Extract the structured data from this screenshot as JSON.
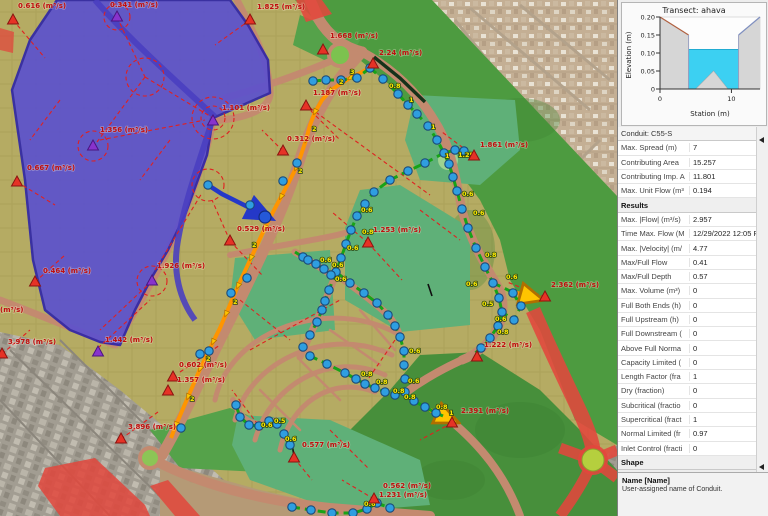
{
  "panel": {
    "transect": {
      "title": "Transect: ahava",
      "ylabel": "Elevation (m)",
      "xlabel": "Station (m)",
      "chart_data": {
        "type": "area",
        "x_range": [
          0,
          14
        ],
        "y_range": [
          0,
          0.2
        ],
        "yticks": [
          {
            "v": "0.20",
            "e": 0.2
          },
          {
            "v": "0.15",
            "e": 0.15
          },
          {
            "v": "0.10",
            "e": 0.1
          },
          {
            "v": "0.05",
            "e": 0.05
          },
          {
            "v": "0",
            "e": 0.0
          }
        ],
        "xticks": [
          {
            "v": "0",
            "s": 0
          },
          {
            "v": "10",
            "s": 10
          }
        ],
        "ground_left": [
          [
            0,
            0.2
          ],
          [
            4,
            0.15
          ]
        ],
        "ground_right": [
          [
            11,
            0.15
          ],
          [
            14,
            0.2
          ]
        ],
        "channel_top": 0.15,
        "water_level": 0.11,
        "island": [
          [
            5,
            0
          ],
          [
            7.5,
            0.05
          ],
          [
            9.5,
            0
          ]
        ],
        "water_color": "#3cd0f2"
      }
    },
    "grid": {
      "rows": [
        {
          "type": "cat0",
          "label": "Conduit: C55-S"
        },
        {
          "type": "row",
          "label": "Max. Spread (m)",
          "value": "7"
        },
        {
          "type": "row",
          "label": "Contributing Area",
          "value": "15.257"
        },
        {
          "type": "row",
          "label": "Contributing Imp. A",
          "value": "11.801"
        },
        {
          "type": "row",
          "label": "Max. Unit Flow (m³",
          "value": "0.194"
        },
        {
          "type": "cat",
          "label": "Results"
        },
        {
          "type": "row",
          "label": "Max. |Flow| (m³/s)",
          "value": "2.957"
        },
        {
          "type": "row",
          "label": "Time Max. Flow (M",
          "value": "12/29/2022 12:05 PM"
        },
        {
          "type": "row",
          "label": "Max. |Velocity| (m/",
          "value": "4.77"
        },
        {
          "type": "row",
          "label": "Max/Full Flow",
          "value": "0.41"
        },
        {
          "type": "row",
          "label": "Max/Full Depth",
          "value": "0.57"
        },
        {
          "type": "row",
          "label": "Max. Volume (m³)",
          "value": "0"
        },
        {
          "type": "row",
          "label": "Full Both Ends (h)",
          "value": "0"
        },
        {
          "type": "row",
          "label": "Full Upstream (h)",
          "value": "0"
        },
        {
          "type": "row",
          "label": "Full Downstream (",
          "value": "0"
        },
        {
          "type": "row",
          "label": "Above Full Norma",
          "value": "0"
        },
        {
          "type": "row",
          "label": "Capacity Limited (",
          "value": "0"
        },
        {
          "type": "row",
          "label": "Length Factor (fra",
          "value": "1"
        },
        {
          "type": "row",
          "label": "Dry (fraction)",
          "value": "0"
        },
        {
          "type": "row",
          "label": "Subcritical (fractio",
          "value": "0"
        },
        {
          "type": "row",
          "label": "Supercritical (fract",
          "value": "1"
        },
        {
          "type": "row",
          "label": "Normal Limited (fr",
          "value": "0.97"
        },
        {
          "type": "row",
          "label": "Inlet Control (fracti",
          "value": "0"
        },
        {
          "type": "cat",
          "label": "Shape"
        }
      ]
    },
    "description": {
      "title": "Name [Name]",
      "text": "User-assigned name of Conduit."
    }
  },
  "map": {
    "flow_labels": [
      {
        "text": "0.616 (m³/s)",
        "x": 18,
        "y": 8
      },
      {
        "text": "0.341 (m³/s)",
        "x": 110,
        "y": 7
      },
      {
        "text": "1.825 (m³/s)",
        "x": 257,
        "y": 9
      },
      {
        "text": "1.668 (m³/s)",
        "x": 330,
        "y": 38
      },
      {
        "text": "2.24 (m³/s)",
        "x": 379,
        "y": 55
      },
      {
        "text": "1.187 (m³/s)",
        "x": 313,
        "y": 95
      },
      {
        "text": "1.101 (m³/s)",
        "x": 222,
        "y": 110
      },
      {
        "text": "1.356 (m³/s)",
        "x": 100,
        "y": 132
      },
      {
        "text": "0.312 (m³/s)",
        "x": 287,
        "y": 141
      },
      {
        "text": "1.861 (m³/s)",
        "x": 480,
        "y": 147
      },
      {
        "text": "0.667 (m³/s)",
        "x": 27,
        "y": 170
      },
      {
        "text": "0.529 (m³/s)",
        "x": 237,
        "y": 231
      },
      {
        "text": "1.253 (m³/s)",
        "x": 373,
        "y": 232
      },
      {
        "text": "0.464 (m³/s)",
        "x": 43,
        "y": 273
      },
      {
        "text": "1.926 (m³/s)",
        "x": 157,
        "y": 268
      },
      {
        "text": "2.362 (m³/s)",
        "x": 551,
        "y": 287
      },
      {
        "text": "(m³/s)",
        "x": 0,
        "y": 312
      },
      {
        "text": "3.978 (m³/s)",
        "x": 8,
        "y": 344
      },
      {
        "text": "1.442 (m³/s)",
        "x": 105,
        "y": 342
      },
      {
        "text": "1.222 (m³/s)",
        "x": 484,
        "y": 347
      },
      {
        "text": "0.602 (m³/s)",
        "x": 179,
        "y": 367
      },
      {
        "text": "1.357 (m³/s)",
        "x": 177,
        "y": 382
      },
      {
        "text": "2.391 (m³/s)",
        "x": 461,
        "y": 413
      },
      {
        "text": "3.896 (m³/s)",
        "x": 128,
        "y": 429
      },
      {
        "text": "0.577 (m³/s)",
        "x": 302,
        "y": 447
      },
      {
        "text": "0.562 (m³/s)",
        "x": 383,
        "y": 488
      },
      {
        "text": "1.231 (m³/s)",
        "x": 379,
        "y": 497
      }
    ],
    "triangles": [
      {
        "x": 13,
        "y": 20,
        "c": "red"
      },
      {
        "x": 117,
        "y": 17,
        "c": "purple"
      },
      {
        "x": 250,
        "y": 20,
        "c": "red"
      },
      {
        "x": 323,
        "y": 50,
        "c": "red"
      },
      {
        "x": 373,
        "y": 64,
        "c": "red"
      },
      {
        "x": 306,
        "y": 106,
        "c": "red"
      },
      {
        "x": 213,
        "y": 121,
        "c": "purple"
      },
      {
        "x": 93,
        "y": 146,
        "c": "purple"
      },
      {
        "x": 283,
        "y": 151,
        "c": "red"
      },
      {
        "x": 474,
        "y": 156,
        "c": "red"
      },
      {
        "x": 17,
        "y": 182,
        "c": "red"
      },
      {
        "x": 230,
        "y": 241,
        "c": "red"
      },
      {
        "x": 368,
        "y": 243,
        "c": "red"
      },
      {
        "x": 545,
        "y": 297,
        "c": "red"
      },
      {
        "x": 35,
        "y": 282,
        "c": "red"
      },
      {
        "x": 152,
        "y": 281,
        "c": "purple"
      },
      {
        "x": 2,
        "y": 354,
        "c": "red"
      },
      {
        "x": 98,
        "y": 352,
        "c": "purple"
      },
      {
        "x": 173,
        "y": 377,
        "c": "red"
      },
      {
        "x": 168,
        "y": 391,
        "c": "red"
      },
      {
        "x": 121,
        "y": 439,
        "c": "red"
      },
      {
        "x": 294,
        "y": 458,
        "c": "red"
      },
      {
        "x": 477,
        "y": 357,
        "c": "red"
      },
      {
        "x": 452,
        "y": 423,
        "c": "red"
      },
      {
        "x": 374,
        "y": 499,
        "c": "red"
      }
    ],
    "net_labels": [
      {
        "text": "3",
        "x": 350,
        "y": 74
      },
      {
        "text": "2",
        "x": 339,
        "y": 84
      },
      {
        "text": "2",
        "x": 312,
        "y": 131
      },
      {
        "text": "2",
        "x": 298,
        "y": 173
      },
      {
        "text": "2",
        "x": 252,
        "y": 247
      },
      {
        "text": "2",
        "x": 233,
        "y": 304
      },
      {
        "text": "2",
        "x": 206,
        "y": 361
      },
      {
        "text": "2",
        "x": 190,
        "y": 401
      },
      {
        "text": "0.8",
        "x": 389,
        "y": 88
      },
      {
        "text": "1",
        "x": 409,
        "y": 102
      },
      {
        "text": "1",
        "x": 431,
        "y": 129
      },
      {
        "text": "1",
        "x": 445,
        "y": 158
      },
      {
        "text": "1.25",
        "x": 458,
        "y": 157
      },
      {
        "text": "0.6",
        "x": 462,
        "y": 196
      },
      {
        "text": "0.6",
        "x": 473,
        "y": 215
      },
      {
        "text": "0.8",
        "x": 485,
        "y": 257
      },
      {
        "text": "0.6",
        "x": 466,
        "y": 286
      },
      {
        "text": "0.6",
        "x": 506,
        "y": 279
      },
      {
        "text": "0.5",
        "x": 482,
        "y": 306
      },
      {
        "text": "0.6",
        "x": 495,
        "y": 321
      },
      {
        "text": "0.8",
        "x": 497,
        "y": 334
      },
      {
        "text": "0.6",
        "x": 361,
        "y": 212
      },
      {
        "text": "0.8",
        "x": 362,
        "y": 234
      },
      {
        "text": "0.6",
        "x": 347,
        "y": 250
      },
      {
        "text": "0.6",
        "x": 320,
        "y": 262
      },
      {
        "text": "0.6",
        "x": 332,
        "y": 267
      },
      {
        "text": "0.6",
        "x": 335,
        "y": 281
      },
      {
        "text": "0.6",
        "x": 409,
        "y": 353
      },
      {
        "text": "0.6",
        "x": 408,
        "y": 383
      },
      {
        "text": "0.8",
        "x": 361,
        "y": 376
      },
      {
        "text": "0.8",
        "x": 376,
        "y": 384
      },
      {
        "text": "0.8",
        "x": 393,
        "y": 393
      },
      {
        "text": "0.8",
        "x": 404,
        "y": 399
      },
      {
        "text": "0.8",
        "x": 436,
        "y": 409
      },
      {
        "text": "1",
        "x": 449,
        "y": 415
      },
      {
        "text": "0.6",
        "x": 261,
        "y": 427
      },
      {
        "text": "0.5",
        "x": 274,
        "y": 423
      },
      {
        "text": "0.6",
        "x": 285,
        "y": 441
      },
      {
        "text": "0.6",
        "x": 364,
        "y": 506
      }
    ],
    "junctions": [
      [
        313,
        81
      ],
      [
        326,
        80
      ],
      [
        341,
        80
      ],
      [
        357,
        78
      ],
      [
        370,
        68
      ],
      [
        383,
        79
      ],
      [
        398,
        94
      ],
      [
        408,
        105
      ],
      [
        417,
        114
      ],
      [
        428,
        126
      ],
      [
        437,
        140
      ],
      [
        444,
        153
      ],
      [
        449,
        164
      ],
      [
        453,
        177
      ],
      [
        457,
        191
      ],
      [
        462,
        209
      ],
      [
        468,
        228
      ],
      [
        476,
        248
      ],
      [
        485,
        267
      ],
      [
        493,
        283
      ],
      [
        499,
        298
      ],
      [
        502,
        312
      ],
      [
        498,
        326
      ],
      [
        490,
        338
      ],
      [
        481,
        348
      ],
      [
        455,
        150
      ],
      [
        464,
        151
      ],
      [
        513,
        293
      ],
      [
        521,
        306
      ],
      [
        514,
        320
      ],
      [
        425,
        163
      ],
      [
        408,
        171
      ],
      [
        390,
        180
      ],
      [
        374,
        192
      ],
      [
        365,
        204
      ],
      [
        357,
        216
      ],
      [
        351,
        230
      ],
      [
        346,
        244
      ],
      [
        341,
        258
      ],
      [
        336,
        272
      ],
      [
        303,
        257
      ],
      [
        308,
        260
      ],
      [
        316,
        264
      ],
      [
        324,
        269
      ],
      [
        331,
        275
      ],
      [
        350,
        283
      ],
      [
        364,
        293
      ],
      [
        377,
        303
      ],
      [
        388,
        315
      ],
      [
        395,
        326
      ],
      [
        400,
        337
      ],
      [
        404,
        351
      ],
      [
        404,
        365
      ],
      [
        405,
        379
      ],
      [
        329,
        290
      ],
      [
        325,
        301
      ],
      [
        322,
        310
      ],
      [
        317,
        322
      ],
      [
        310,
        335
      ],
      [
        303,
        347
      ],
      [
        310,
        356
      ],
      [
        327,
        364
      ],
      [
        345,
        373
      ],
      [
        356,
        379
      ],
      [
        365,
        384
      ],
      [
        375,
        388
      ],
      [
        385,
        392
      ],
      [
        395,
        395
      ],
      [
        405,
        392
      ],
      [
        414,
        401
      ],
      [
        425,
        407
      ],
      [
        436,
        413
      ],
      [
        236,
        405
      ],
      [
        240,
        417
      ],
      [
        249,
        425
      ],
      [
        259,
        426
      ],
      [
        269,
        421
      ],
      [
        277,
        424
      ],
      [
        284,
        434
      ],
      [
        290,
        445
      ],
      [
        292,
        507
      ],
      [
        311,
        510
      ],
      [
        332,
        513
      ],
      [
        353,
        513
      ],
      [
        367,
        509
      ],
      [
        377,
        503
      ],
      [
        390,
        508
      ],
      [
        297,
        163
      ],
      [
        283,
        181
      ],
      [
        247,
        278
      ],
      [
        231,
        293
      ],
      [
        200,
        354
      ],
      [
        209,
        351
      ],
      [
        181,
        428
      ],
      [
        208,
        185
      ],
      [
        250,
        205
      ]
    ],
    "big_node": {
      "x": 265,
      "y": 217
    }
  }
}
